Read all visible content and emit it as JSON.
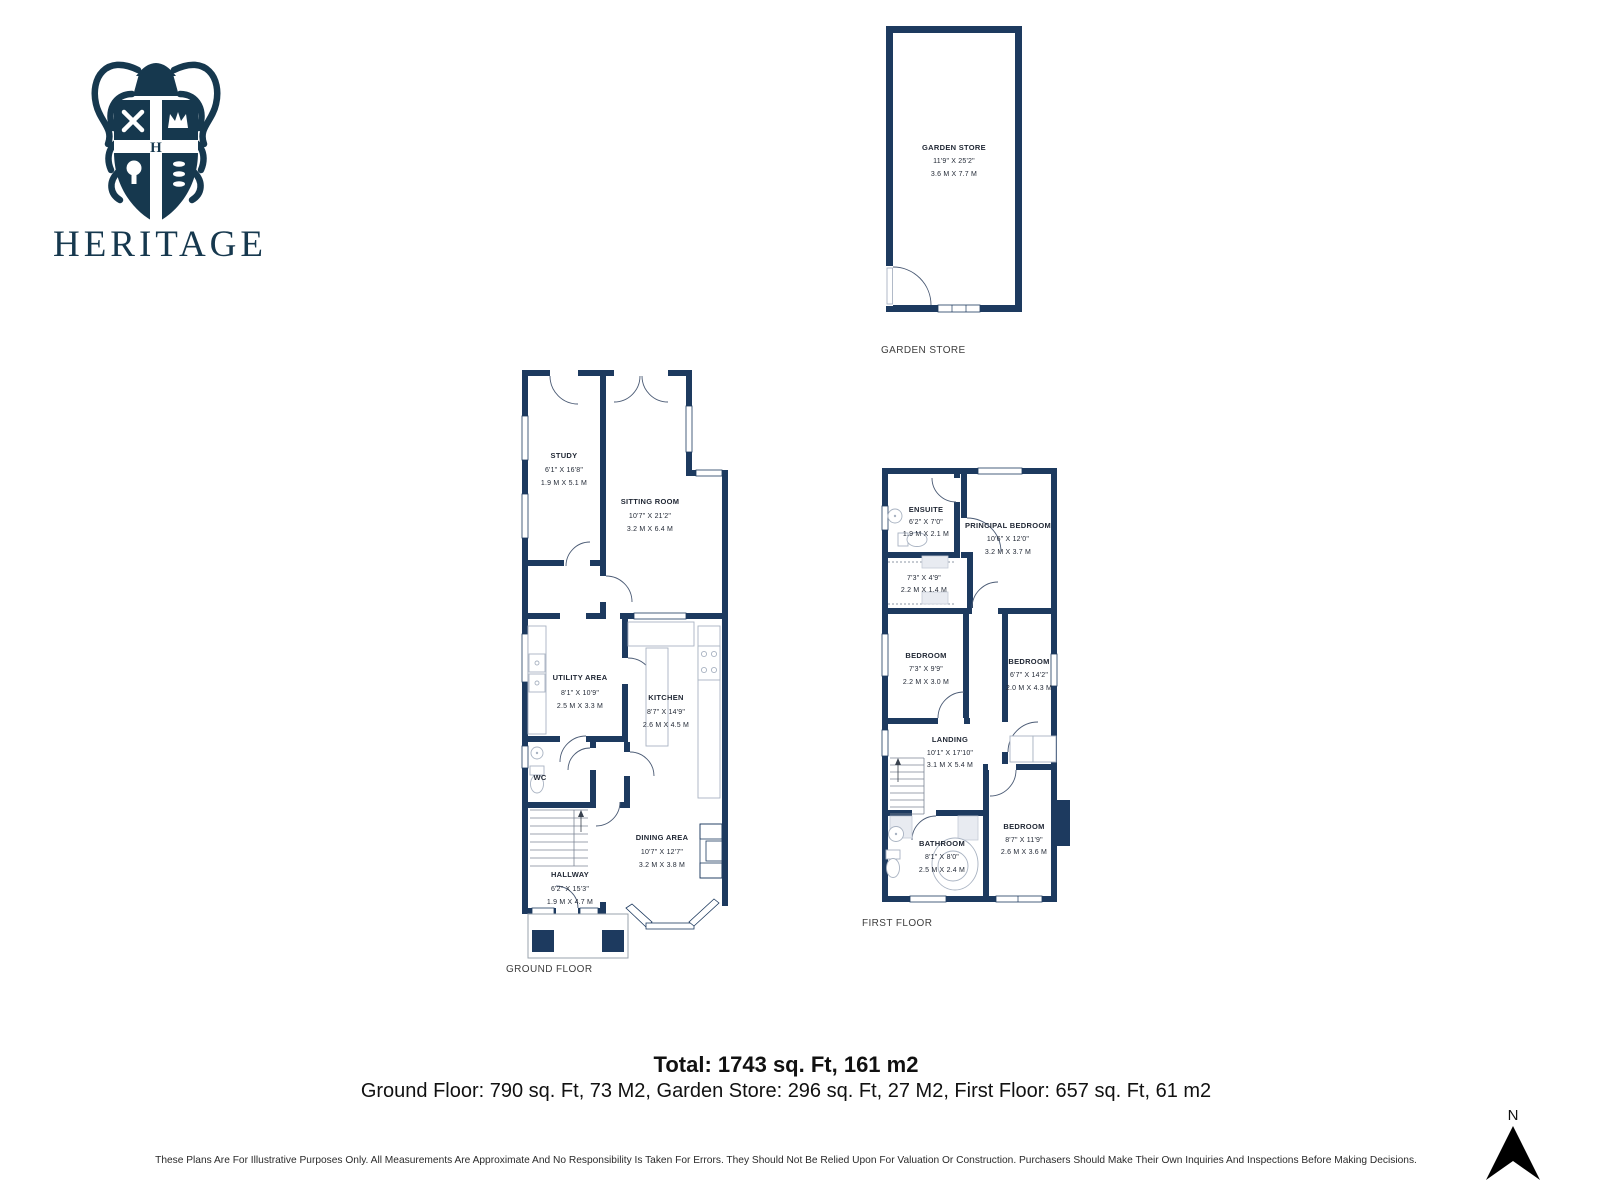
{
  "brand": {
    "name": "HERITAGE"
  },
  "colors": {
    "wall_navy": "#1d3a5f",
    "logo_navy": "#16384e",
    "text_dark": "#1f2633"
  },
  "garden_store": {
    "plan_label": "GARDEN STORE",
    "room": {
      "name": "GARDEN STORE",
      "imperial": "11'9\" X 25'2\"",
      "metric": "3.6 M X 7.7 M"
    }
  },
  "ground_floor": {
    "plan_label": "GROUND FLOOR",
    "rooms": {
      "study": {
        "name": "STUDY",
        "imperial": "6'1\" X 16'8\"",
        "metric": "1.9 M X 5.1 M"
      },
      "sitting": {
        "name": "SITTING ROOM",
        "imperial": "10'7\" X 21'2\"",
        "metric": "3.2 M X 6.4 M"
      },
      "utility": {
        "name": "UTILITY AREA",
        "imperial": "8'1\" X 10'9\"",
        "metric": "2.5 M X 3.3 M"
      },
      "kitchen": {
        "name": "KITCHEN",
        "imperial": "8'7\" X 14'9\"",
        "metric": "2.6 M X 4.5 M"
      },
      "wc": {
        "name": "WC"
      },
      "dining": {
        "name": "DINING AREA",
        "imperial": "10'7\" X 12'7\"",
        "metric": "3.2 M X 3.8 M"
      },
      "hallway": {
        "name": "HALLWAY",
        "imperial": "6'2\" X 15'3\"",
        "metric": "1.9 M X 4.7 M"
      }
    }
  },
  "first_floor": {
    "plan_label": "FIRST FLOOR",
    "rooms": {
      "ensuite": {
        "name": "ENSUITE",
        "imperial": "6'2\" X 7'0\"",
        "metric": "1.9 M X 2.1 M"
      },
      "principal": {
        "name": "PRINCIPAL BEDROOM",
        "imperial": "10'6\" X 12'0\"",
        "metric": "3.2 M X 3.7 M"
      },
      "closet": {
        "imperial": "7'3\" X 4'9\"",
        "metric": "2.2 M X 1.4 M"
      },
      "bedroom_left": {
        "name": "BEDROOM",
        "imperial": "7'3\" X 9'9\"",
        "metric": "2.2 M X 3.0 M"
      },
      "bedroom_right": {
        "name": "BEDROOM",
        "imperial": "6'7\" X 14'2\"",
        "metric": "2.0 M X 4.3 M"
      },
      "landing": {
        "name": "LANDING",
        "imperial": "10'1\" X 17'10\"",
        "metric": "3.1 M X 5.4 M"
      },
      "bathroom": {
        "name": "BATHROOM",
        "imperial": "8'1\" X 8'0\"",
        "metric": "2.5 M X 2.4 M"
      },
      "bedroom_bottom": {
        "name": "BEDROOM",
        "imperial": "8'7\" X 11'9\"",
        "metric": "2.6 M X 3.6 M"
      }
    }
  },
  "summary": {
    "total": "Total: 1743 sq. Ft, 161 m2",
    "breakdown": "Ground Floor: 790 sq. Ft, 73 M2, Garden Store: 296 sq. Ft, 27 M2, First Floor: 657 sq. Ft, 61 m2"
  },
  "disclaimer": "These Plans Are For Illustrative Purposes Only. All Measurements Are Approximate And No Responsibility Is Taken For Errors. They Should Not Be Relied Upon For Valuation Or Construction. Purchasers Should Make Their Own Inquiries And Inspections Before Making Decisions.",
  "compass": {
    "label": "N"
  }
}
